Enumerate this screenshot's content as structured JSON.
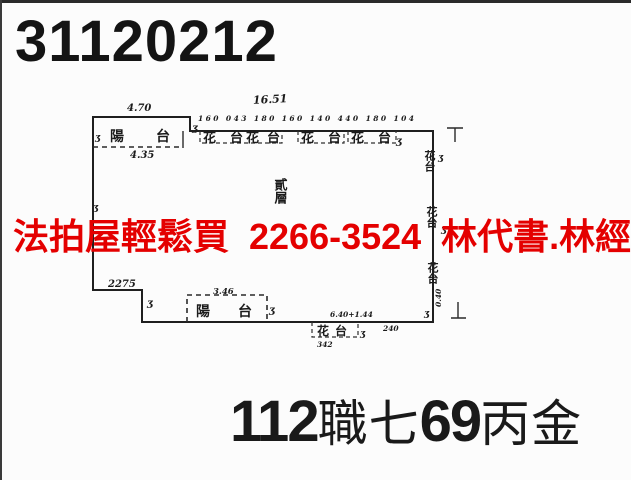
{
  "page": {
    "case_number": "31120212",
    "ad_text": "法拍屋輕鬆買  2266-3524  林代書.林經理",
    "property_code": {
      "segments": [
        {
          "text": "112"
        },
        {
          "text": "職七"
        },
        {
          "text": "69"
        },
        {
          "text": "丙金"
        }
      ]
    },
    "colors": {
      "ad_red": "#e40000",
      "ink": "#1c1c1c",
      "paper": "#fcfcfc"
    }
  },
  "floor_plan": {
    "overall_width_dim": "16.51",
    "top_dims_row": "160 043 180 160 140 440 180 104",
    "balcony_top": {
      "label": "陽 台",
      "dim_above": "4.70",
      "dim_below": "4.35"
    },
    "balcony_bottom": {
      "label": "陽 台",
      "dim_above": "3.46"
    },
    "center_floor_label": "貳層",
    "flower_beds_top": [
      "花台",
      "花台",
      "花台",
      "花台"
    ],
    "flower_beds_right": [
      "花台",
      "花台",
      "花台"
    ],
    "flower_bed_bottom": {
      "label": "花台",
      "dim_below": "342"
    },
    "left_bottom_dim": "2275",
    "bottom_right_dim": "6.40+1.44",
    "bottom_right_dim2": "240",
    "corner_dim": "0.40",
    "squiggle_mark": "ʒ"
  }
}
